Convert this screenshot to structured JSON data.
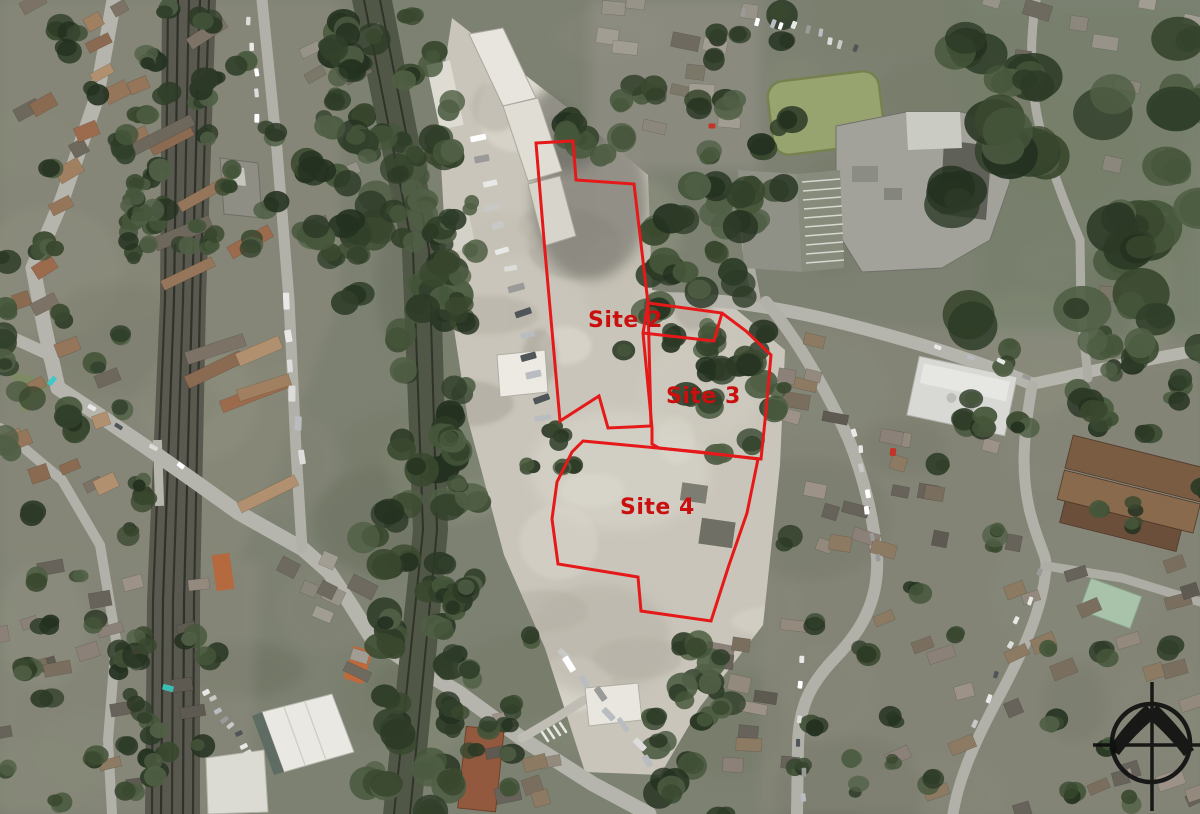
{
  "map": {
    "type": "aerial-photograph-site-plan",
    "sites": [
      {
        "id": "site-2",
        "label": "Site 2"
      },
      {
        "id": "site-3",
        "label": "Site 3"
      },
      {
        "id": "site-4",
        "label": "Site 4"
      }
    ],
    "boundary_color": "#e51919",
    "label_color": "#c9100f",
    "compass": {
      "icon": "north-arrow-compass",
      "color": "#0d0d0d"
    }
  }
}
